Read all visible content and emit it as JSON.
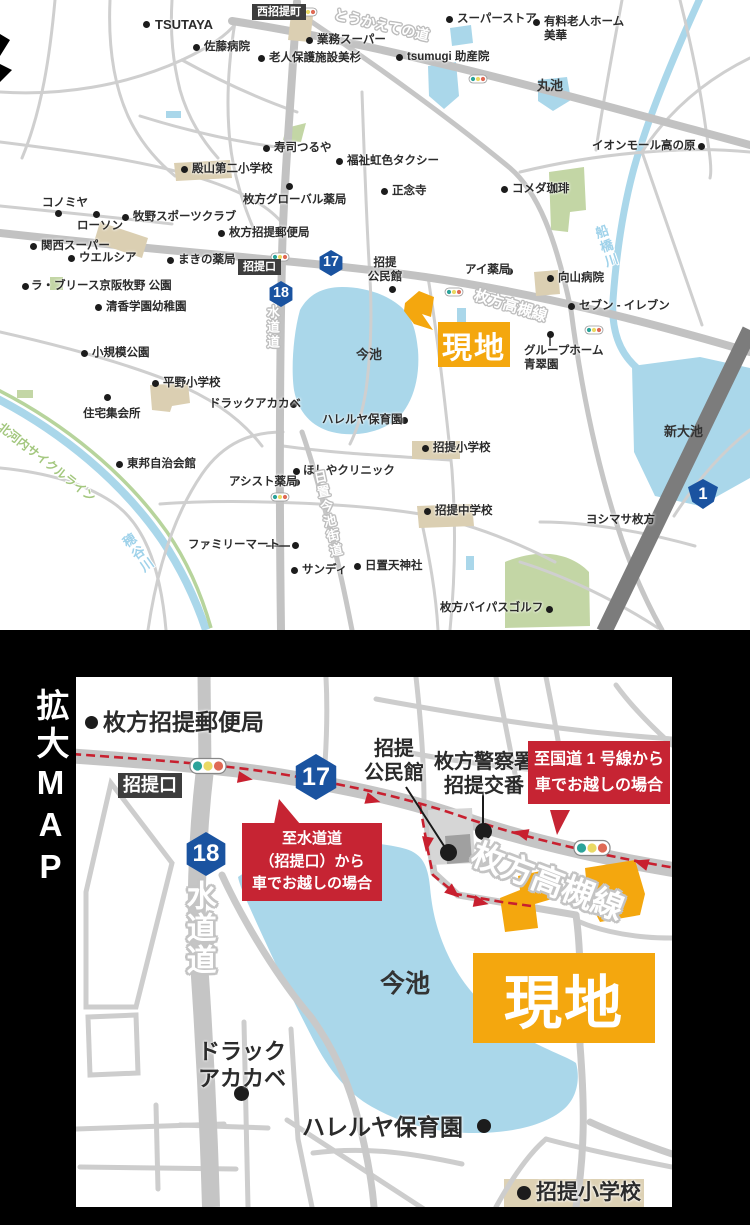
{
  "colors": {
    "site_orange": "#f4a70e",
    "route_red": "#c8202f",
    "callout_red": "#c62433",
    "water_blue": "#aad7ea",
    "road_gray": "#c5c5c5",
    "shield_blue": "#1a53a0",
    "building_beige": "#dbcfb2",
    "green_area": "#c3d6a5",
    "national_road_gray": "#7c7c7c"
  },
  "top_map": {
    "site_label": "現地",
    "markers": [
      {
        "t": "poi",
        "label": "TSUTAYA",
        "x": 155,
        "y": 17,
        "dx": 146,
        "dy": 24,
        "fs": 13
      },
      {
        "t": "badge",
        "label": "西招提町",
        "x": 252,
        "y": 4,
        "fs": 11
      },
      {
        "t": "road",
        "label": "とうかえての道",
        "x": 336,
        "y": 6,
        "rot": 13,
        "fs": 14
      },
      {
        "t": "poi",
        "label": "スーパーストア",
        "x": 457,
        "y": 12,
        "dx": 449,
        "dy": 19
      },
      {
        "t": "poi",
        "label": "有料老人ホーム\n美華",
        "x": 544,
        "y": 15,
        "dx": 536,
        "dy": 22
      },
      {
        "t": "poi",
        "label": "業務スーパー",
        "x": 317,
        "y": 33,
        "dx": 309,
        "dy": 40
      },
      {
        "t": "poi",
        "label": "佐藤病院",
        "x": 204,
        "y": 40,
        "dx": 196,
        "dy": 47
      },
      {
        "t": "poi",
        "label": "老人保護施設美杉",
        "x": 269,
        "y": 51,
        "dx": 261,
        "dy": 58
      },
      {
        "t": "poi",
        "label": "tsumugi 助産院",
        "x": 407,
        "y": 50,
        "dx": 399,
        "dy": 57
      },
      {
        "t": "text",
        "label": "丸池",
        "x": 537,
        "y": 78,
        "fs": 13
      },
      {
        "t": "poi",
        "label": "イオンモール高の原",
        "x": 592,
        "y": 139,
        "dx": 701,
        "dy": 146
      },
      {
        "t": "poi",
        "label": "寿司つるや",
        "x": 274,
        "y": 141,
        "dx": 266,
        "dy": 148
      },
      {
        "t": "poi",
        "label": "福祉虹色タクシー",
        "x": 347,
        "y": 154,
        "dx": 339,
        "dy": 161
      },
      {
        "t": "poi",
        "label": "殿山第二小学校",
        "x": 192,
        "y": 162,
        "dx": 184,
        "dy": 169
      },
      {
        "t": "poi",
        "label": "枚方グローバル薬局",
        "x": 243,
        "y": 193,
        "dx": 289,
        "dy": 186
      },
      {
        "t": "poi",
        "label": "正念寺",
        "x": 392,
        "y": 184,
        "dx": 384,
        "dy": 191
      },
      {
        "t": "poi",
        "label": "コメダ珈琲",
        "x": 512,
        "y": 182,
        "dx": 504,
        "dy": 189
      },
      {
        "t": "poi",
        "label": "コノミヤ",
        "x": 42,
        "y": 196,
        "dx": 58,
        "dy": 213
      },
      {
        "t": "poi",
        "label": "ローソン",
        "x": 77,
        "y": 219,
        "dx": 96,
        "dy": 214
      },
      {
        "t": "poi",
        "label": "牧野スポーツクラブ",
        "x": 133,
        "y": 210,
        "dx": 125,
        "dy": 217
      },
      {
        "t": "poi",
        "label": "枚方招提郵便局",
        "x": 229,
        "y": 226,
        "dx": 221,
        "dy": 233
      },
      {
        "t": "poi",
        "label": "関西スーパー",
        "x": 41,
        "y": 239,
        "dx": 33,
        "dy": 246
      },
      {
        "t": "poi",
        "label": "ウエルシア",
        "x": 79,
        "y": 251,
        "dx": 71,
        "dy": 258
      },
      {
        "t": "poi",
        "label": "まきの薬局",
        "x": 178,
        "y": 253,
        "dx": 170,
        "dy": 260
      },
      {
        "t": "badge",
        "label": "招提口",
        "x": 238,
        "y": 259,
        "fs": 11
      },
      {
        "t": "shield",
        "label": "17",
        "x": 331,
        "y": 263,
        "s": 26
      },
      {
        "t": "shield",
        "label": "18",
        "x": 281,
        "y": 294,
        "s": 26
      },
      {
        "t": "poi",
        "label": "招提\n公民館",
        "x": 362,
        "y": 256,
        "w": 46,
        "dx": 392,
        "dy": 289
      },
      {
        "t": "poi",
        "label": "アイ薬局",
        "x": 465,
        "y": 263,
        "dx": 509,
        "dy": 271
      },
      {
        "t": "poi",
        "label": "向山病院",
        "x": 558,
        "y": 271,
        "dx": 550,
        "dy": 278
      },
      {
        "t": "road",
        "label": "枚方高槻線",
        "x": 477,
        "y": 287,
        "rot": 17,
        "fs": 15
      },
      {
        "t": "poi",
        "label": "セブン - イレブン",
        "x": 579,
        "y": 299,
        "dx": 571,
        "dy": 306
      },
      {
        "t": "poi",
        "label": "グループホーム\n青翠園",
        "x": 524,
        "y": 344,
        "dx": 550,
        "dy": 334
      },
      {
        "t": "road",
        "label": "水道道",
        "x": 264,
        "y": 305,
        "vert": true,
        "fs": 13
      },
      {
        "t": "text",
        "label": "今池",
        "x": 356,
        "y": 347,
        "fs": 13
      },
      {
        "t": "text",
        "label": "新大池",
        "x": 664,
        "y": 424,
        "fs": 13
      },
      {
        "t": "poi",
        "label": "ラ・ブリース京阪牧野 公園",
        "x": 31,
        "y": 279,
        "dx": 25,
        "dy": 286
      },
      {
        "t": "poi",
        "label": "清香学園幼稚園",
        "x": 106,
        "y": 300,
        "dx": 98,
        "dy": 307
      },
      {
        "t": "poi",
        "label": "小規模公園",
        "x": 92,
        "y": 346,
        "dx": 84,
        "dy": 353
      },
      {
        "t": "poi",
        "label": "平野小学校",
        "x": 163,
        "y": 376,
        "dx": 155,
        "dy": 383
      },
      {
        "t": "poi",
        "label": "住宅集会所",
        "x": 83,
        "y": 407,
        "dx": 107,
        "dy": 397
      },
      {
        "t": "poi",
        "label": "ドラックアカカベ",
        "x": 209,
        "y": 397,
        "dx": 293,
        "dy": 404
      },
      {
        "t": "poi",
        "label": "ハレルヤ保育園",
        "x": 322,
        "y": 413,
        "dx": 404,
        "dy": 420
      },
      {
        "t": "poi",
        "label": "招提小学校",
        "x": 433,
        "y": 441,
        "dx": 425,
        "dy": 448
      },
      {
        "t": "poi",
        "label": "東邦自治会館",
        "x": 127,
        "y": 457,
        "dx": 119,
        "dy": 464
      },
      {
        "t": "poi",
        "label": "アシスト薬局",
        "x": 229,
        "y": 475,
        "dx": 296,
        "dy": 482
      },
      {
        "t": "poi",
        "label": "ほしやクリニック",
        "x": 303,
        "y": 464,
        "dx": 296,
        "dy": 471
      },
      {
        "t": "road",
        "label": "日置今池街道",
        "x": 310,
        "y": 472,
        "vert": true,
        "rot": -12,
        "fs": 13
      },
      {
        "t": "cycle",
        "label": "北河内サイクルライン",
        "x": 4,
        "y": 420,
        "rot": 38,
        "fs": 12
      },
      {
        "t": "water",
        "label": "穂谷川",
        "x": 118,
        "y": 540,
        "vert": true,
        "rot": -35,
        "fs": 13
      },
      {
        "t": "water",
        "label": "船橋川",
        "x": 591,
        "y": 228,
        "vert": true,
        "rot": -18,
        "fs": 13
      },
      {
        "t": "poi",
        "label": "ファミリーマート",
        "x": 188,
        "y": 538,
        "dx": 295,
        "dy": 545
      },
      {
        "t": "poi",
        "label": "サンディ",
        "x": 302,
        "y": 563,
        "dx": 294,
        "dy": 570
      },
      {
        "t": "poi",
        "label": "日置天神社",
        "x": 365,
        "y": 559,
        "dx": 357,
        "dy": 566
      },
      {
        "t": "poi",
        "label": "招提中学校",
        "x": 435,
        "y": 504,
        "dx": 427,
        "dy": 511
      },
      {
        "t": "poi",
        "label": "ヨシマサ枚方",
        "x": 586,
        "y": 513,
        "dx": 650,
        "dy": 520
      },
      {
        "t": "poi",
        "label": "枚方バイパスゴルフ",
        "x": 440,
        "y": 601,
        "dx": 549,
        "dy": 609
      },
      {
        "t": "nshield",
        "label": "1",
        "x": 703,
        "y": 494,
        "s": 30
      }
    ]
  },
  "zoom_map": {
    "title_vertical": "拡大MAP",
    "site_label": "現地",
    "callout_suido": {
      "line1": "至水道道",
      "line2": "（招提口）から",
      "line3": "車でお越しの場合"
    },
    "callout_kokudo": {
      "line1": "至国道 1 号線から",
      "line2": "車でお越しの場合"
    },
    "markers": [
      {
        "t": "poi",
        "label": "枚方招提郵便局",
        "x": 27,
        "y": 31,
        "dx": 15,
        "dy": 45,
        "ds": 13,
        "fs": 23
      },
      {
        "t": "badge",
        "label": "招提口",
        "x": 42,
        "y": 96,
        "fs": 18
      },
      {
        "t": "shield",
        "label": "17",
        "x": 240,
        "y": 100,
        "s": 46
      },
      {
        "t": "shield",
        "label": "18",
        "x": 130,
        "y": 177,
        "s": 44
      },
      {
        "t": "poi",
        "label": "招提\n公民館",
        "x": 282,
        "y": 60,
        "w": 72,
        "fs": 20,
        "dx": 372,
        "dy": 175,
        "ds": 17
      },
      {
        "t": "poi",
        "label": "枚方警察署\n招提交番",
        "x": 350,
        "y": 73,
        "w": 116,
        "fs": 20,
        "dx": 407,
        "dy": 154,
        "ds": 17
      },
      {
        "t": "road",
        "label": "水道道",
        "x": 103,
        "y": 203,
        "vert": true,
        "fs": 30,
        "thick": true
      },
      {
        "t": "road",
        "label": "枚方高槻線",
        "x": 404,
        "y": 158,
        "rot": 21,
        "fs": 32,
        "thick": true
      },
      {
        "t": "text",
        "label": "今池",
        "x": 304,
        "y": 292,
        "fs": 25
      },
      {
        "t": "poi",
        "label": "ドラック\nアカカベ",
        "x": 116,
        "y": 362,
        "w": 100,
        "fs": 22,
        "dx": 165,
        "dy": 416,
        "ds": 15
      },
      {
        "t": "poi",
        "label": "ハレルヤ保育園",
        "x": 226,
        "y": 436,
        "fs": 23,
        "dx": 408,
        "dy": 449,
        "ds": 14
      },
      {
        "t": "poi",
        "label": "招提小学校",
        "x": 460,
        "y": 503,
        "fs": 21,
        "dx": 448,
        "dy": 516,
        "ds": 14
      }
    ]
  }
}
